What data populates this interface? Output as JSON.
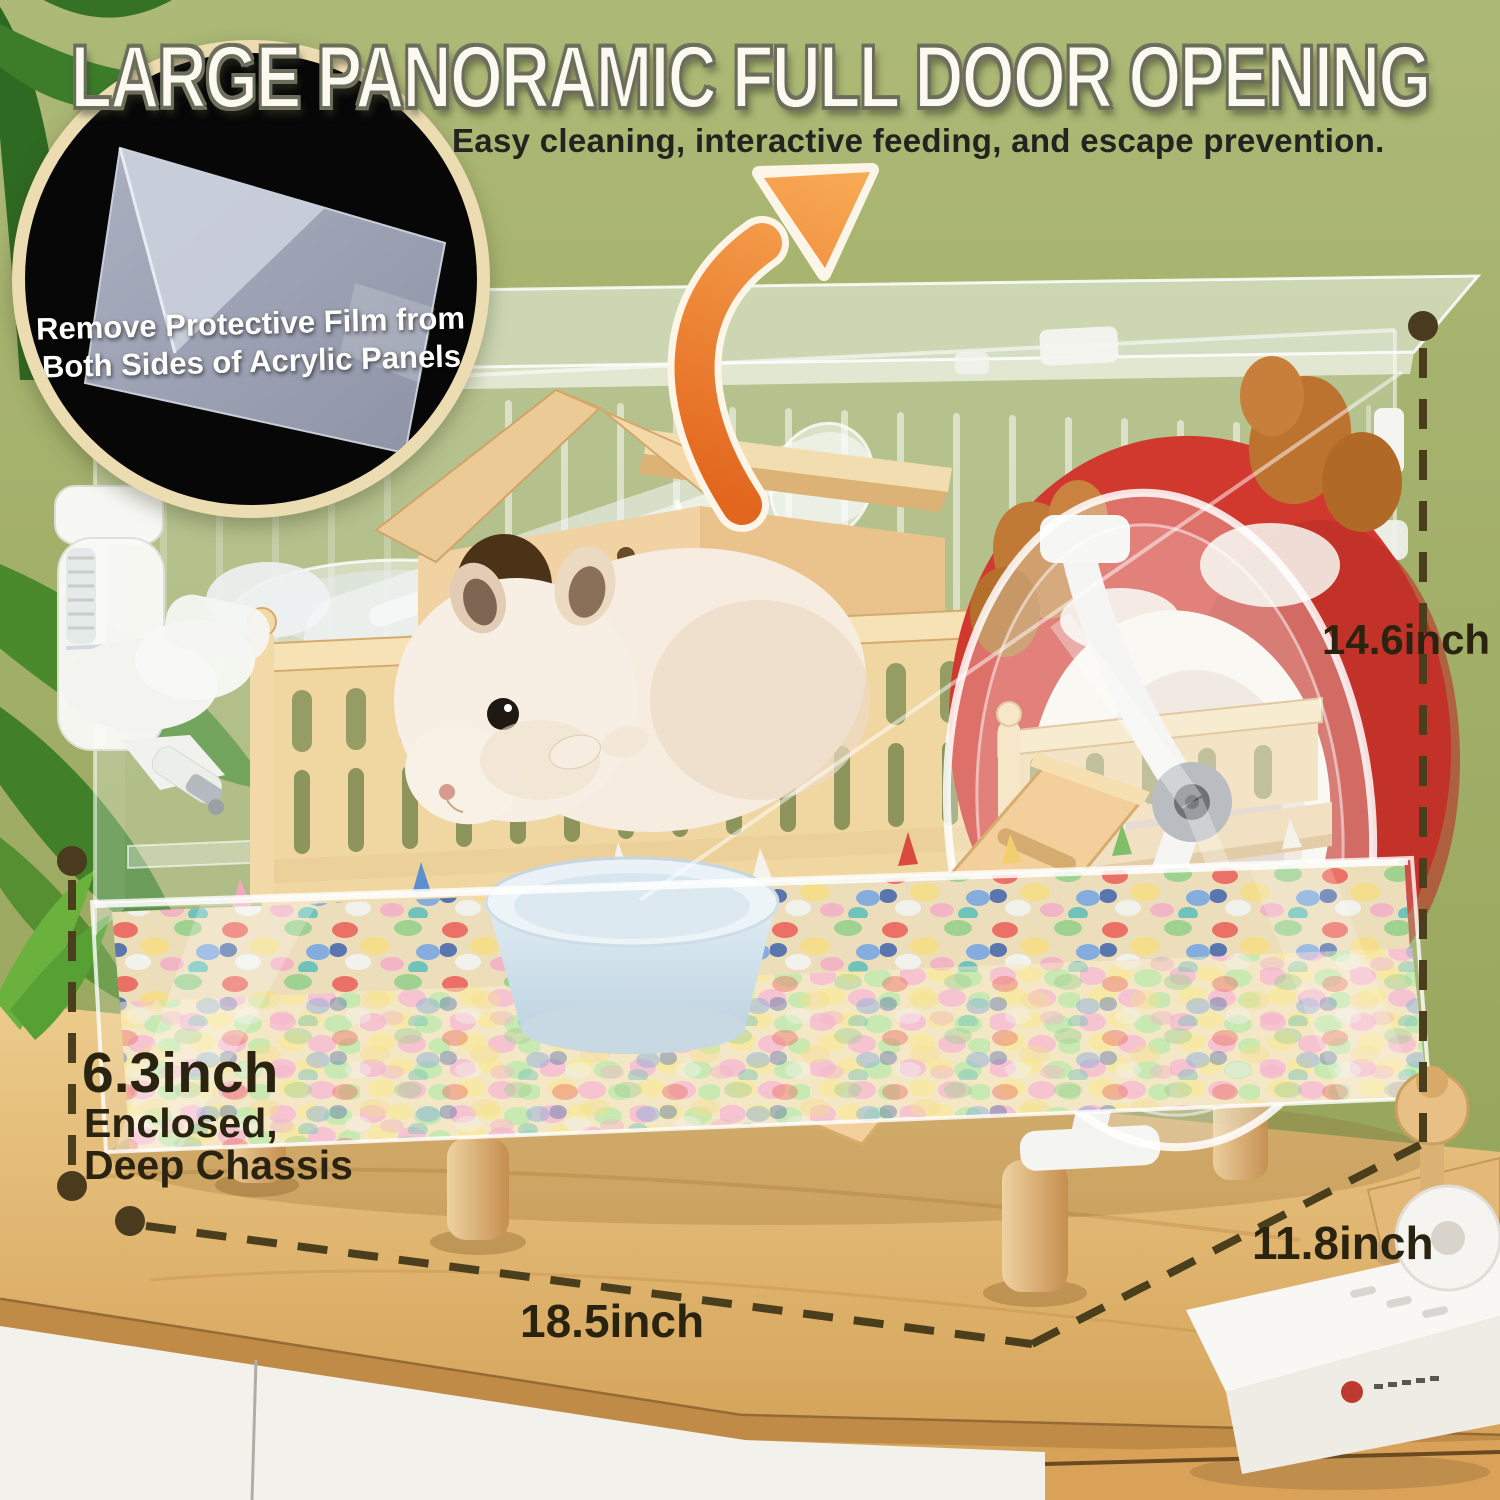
{
  "title": "LARGE PANORAMIC FULL DOOR OPENING",
  "subtitle": "Easy cleaning, interactive feeding, and escape prevention.",
  "inset_badge": {
    "line1": "Remove Protective Film from",
    "line2": "Both Sides of Acrylic Panels"
  },
  "dimensions": {
    "height_label": "14.6inch",
    "width_label": "18.5inch",
    "depth_label": "11.8inch",
    "chassis_height_label": "6.3inch",
    "chassis_note1": "Enclosed,",
    "chassis_note2": "Deep Chassis"
  },
  "colors": {
    "wall": "#a0ae64",
    "title_fill": "#fbf9f0",
    "ring": "#ecdcb2",
    "dimension_ink": "#2a230f",
    "accent_arrow": "#ee8434",
    "red_hideout": "#d2392e",
    "table_wood": "#dfae63"
  }
}
